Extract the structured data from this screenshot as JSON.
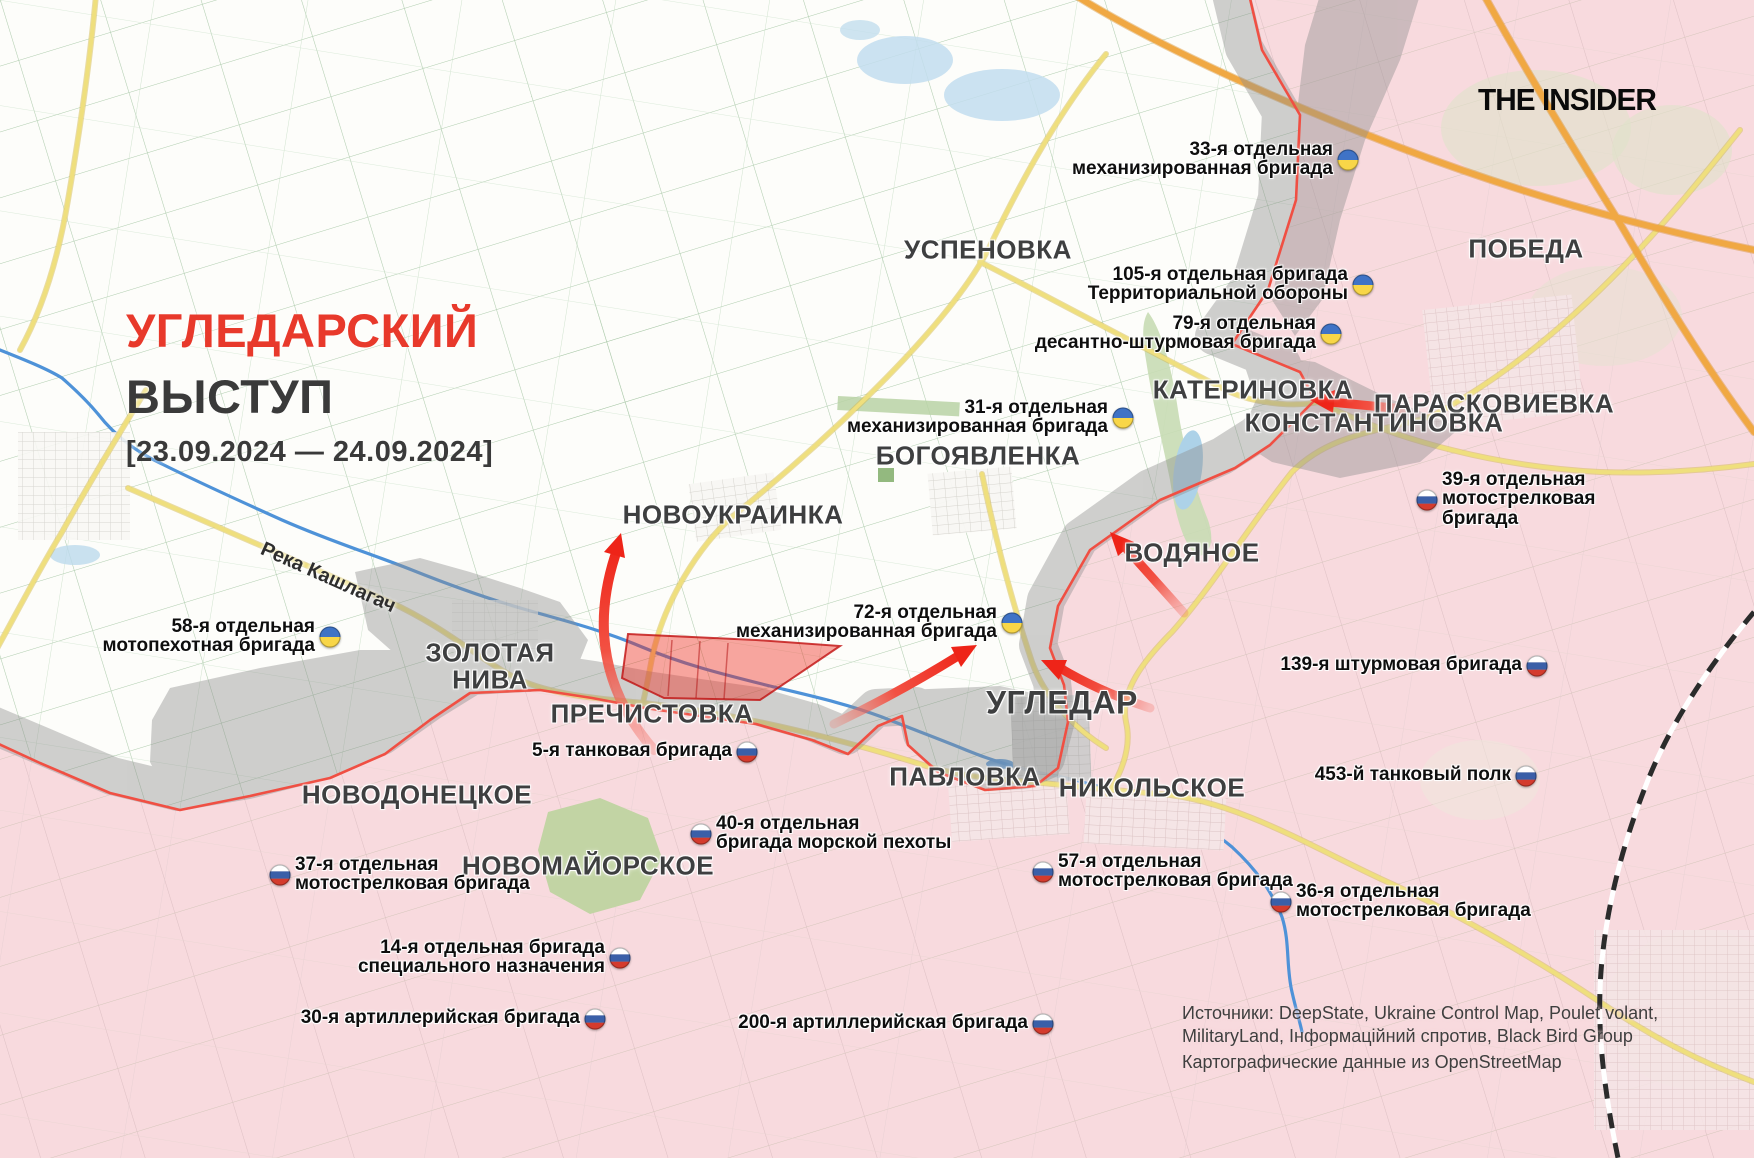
{
  "branding": {
    "logo_text": "THE INSIDER"
  },
  "title": {
    "line1": "УГЛЕДАРСКИЙ",
    "line2": "ВЫСТУП",
    "date_range": "[23.09.2024 — 24.09.2024]"
  },
  "river_label": {
    "text": "Река Кашлагач"
  },
  "sources": {
    "line1": "Источники: DeepState, Ukraine Control Map, Poulet volant,",
    "line2": "MilitaryLand, Інформаційний спротив, Black Bird Group",
    "line3": "Картографические данные из OpenStreetMap"
  },
  "legend_colors": {
    "ukrainian_controlled": "#ffffff",
    "russian_controlled": "#f8dade",
    "contested_gray": "#8f8f8f",
    "frontline_red": "#f04f43",
    "advance_red": "#ee2418",
    "title_accent": "#e8392b",
    "ukraine_flag": [
      "#3f73c6",
      "#f8d648"
    ],
    "russia_flag": [
      "#ffffff",
      "#3a5fa8",
      "#d43b2d"
    ]
  },
  "places": [
    {
      "id": "uspenovka",
      "name": "УСПЕНОВКА",
      "x": 988,
      "y": 250,
      "size": 26
    },
    {
      "id": "pobeda",
      "name": "ПОБЕДА",
      "x": 1526,
      "y": 249,
      "size": 26
    },
    {
      "id": "katerinovka",
      "name": "КАТЕРИНОВКА",
      "x": 1253,
      "y": 390,
      "size": 26
    },
    {
      "id": "paraskovievka",
      "name": "ПАРАСКОВИЕВКА",
      "x": 1494,
      "y": 404,
      "size": 26
    },
    {
      "id": "konstantinovka",
      "name": "КОНСТАНТИНОВКА",
      "x": 1374,
      "y": 423,
      "size": 26
    },
    {
      "id": "bogoyavlenka",
      "name": "БОГОЯВЛЕНКА",
      "x": 978,
      "y": 456,
      "size": 26
    },
    {
      "id": "novoukrainka",
      "name": "НОВОУКРАИНКА",
      "x": 733,
      "y": 515,
      "size": 26
    },
    {
      "id": "vodyanoe",
      "name": "ВОДЯНОЕ",
      "x": 1192,
      "y": 553,
      "size": 26
    },
    {
      "id": "zolotaya-niva",
      "name": "ЗОЛОТАЯ\nНИВА",
      "x": 490,
      "y": 666,
      "size": 26
    },
    {
      "id": "prechistovka",
      "name": "ПРЕЧИСТОВКА",
      "x": 652,
      "y": 714,
      "size": 26
    },
    {
      "id": "ugledar",
      "name": "УГЛЕДАР",
      "x": 1062,
      "y": 703,
      "size": 32
    },
    {
      "id": "pavlovka",
      "name": "ПАВЛОВКА",
      "x": 965,
      "y": 777,
      "size": 26
    },
    {
      "id": "nikolskoe",
      "name": "НИКОЛЬСКОЕ",
      "x": 1152,
      "y": 788,
      "size": 26
    },
    {
      "id": "novodonetskoe",
      "name": "НОВОДОНЕЦКОЕ",
      "x": 417,
      "y": 795,
      "size": 26
    },
    {
      "id": "novomayorskoe",
      "name": "НОВОМАЙОРСКОЕ",
      "x": 588,
      "y": 866,
      "size": 26
    }
  ],
  "units": [
    {
      "id": "unit-ua-33",
      "country": "ukraine",
      "lines": [
        "33-я отдельная",
        "механизированная бригада"
      ],
      "x": 1348,
      "y": 160,
      "flag": "right"
    },
    {
      "id": "unit-ua-105",
      "country": "ukraine",
      "lines": [
        "105-я отдельная бригада",
        "Территориальной обороны"
      ],
      "x": 1363,
      "y": 285,
      "flag": "right"
    },
    {
      "id": "unit-ua-79",
      "country": "ukraine",
      "lines": [
        "79-я отдельная",
        "десантно-штурмовая бригада"
      ],
      "x": 1331,
      "y": 334,
      "flag": "right"
    },
    {
      "id": "unit-ua-31",
      "country": "ukraine",
      "lines": [
        "31-я отдельная",
        "механизированная бригада"
      ],
      "x": 1123,
      "y": 418,
      "flag": "right"
    },
    {
      "id": "unit-ua-72",
      "country": "ukraine",
      "lines": [
        "72-я отдельная",
        "механизированная бригада"
      ],
      "x": 1012,
      "y": 623,
      "flag": "right"
    },
    {
      "id": "unit-ua-58",
      "country": "ukraine",
      "lines": [
        "58-я отдельная",
        "мотопехотная бригада"
      ],
      "x": 330,
      "y": 637,
      "flag": "right"
    },
    {
      "id": "unit-ru-39",
      "country": "russia",
      "lines": [
        "39-я отдельная",
        "мотострелковая",
        "бригада"
      ],
      "x": 1427,
      "y": 500,
      "flag": "left"
    },
    {
      "id": "unit-ru-139",
      "country": "russia",
      "lines": [
        "139-я штурмовая бригада"
      ],
      "x": 1537,
      "y": 666,
      "flag": "right"
    },
    {
      "id": "unit-ru-453",
      "country": "russia",
      "lines": [
        "453-й танковый полк"
      ],
      "x": 1526,
      "y": 776,
      "flag": "right"
    },
    {
      "id": "unit-ru-5",
      "country": "russia",
      "lines": [
        "5-я танковая бригада"
      ],
      "x": 747,
      "y": 752,
      "flag": "right"
    },
    {
      "id": "unit-ru-40",
      "country": "russia",
      "lines": [
        "40-я отдельная",
        "бригада морской пехоты"
      ],
      "x": 701,
      "y": 834,
      "flag": "left"
    },
    {
      "id": "unit-ru-57",
      "country": "russia",
      "lines": [
        "57-я отдельная",
        "мотострелковая бригада"
      ],
      "x": 1043,
      "y": 872,
      "flag": "left"
    },
    {
      "id": "unit-ru-36",
      "country": "russia",
      "lines": [
        "36-я отдельная",
        "мотострелковая бригада"
      ],
      "x": 1281,
      "y": 902,
      "flag": "left"
    },
    {
      "id": "unit-ru-37",
      "country": "russia",
      "lines": [
        "37-я отдельная",
        "мотострелковая бригада"
      ],
      "x": 280,
      "y": 875,
      "flag": "left"
    },
    {
      "id": "unit-ru-14",
      "country": "russia",
      "lines": [
        "14-я отдельная бригада",
        "специального назначения"
      ],
      "x": 620,
      "y": 958,
      "flag": "right"
    },
    {
      "id": "unit-ru-30",
      "country": "russia",
      "lines": [
        "30-я артиллерийская бригада"
      ],
      "x": 595,
      "y": 1019,
      "flag": "right"
    },
    {
      "id": "unit-ru-200",
      "country": "russia",
      "lines": [
        "200-я артиллерийская бригада"
      ],
      "x": 1043,
      "y": 1024,
      "flag": "right"
    }
  ]
}
